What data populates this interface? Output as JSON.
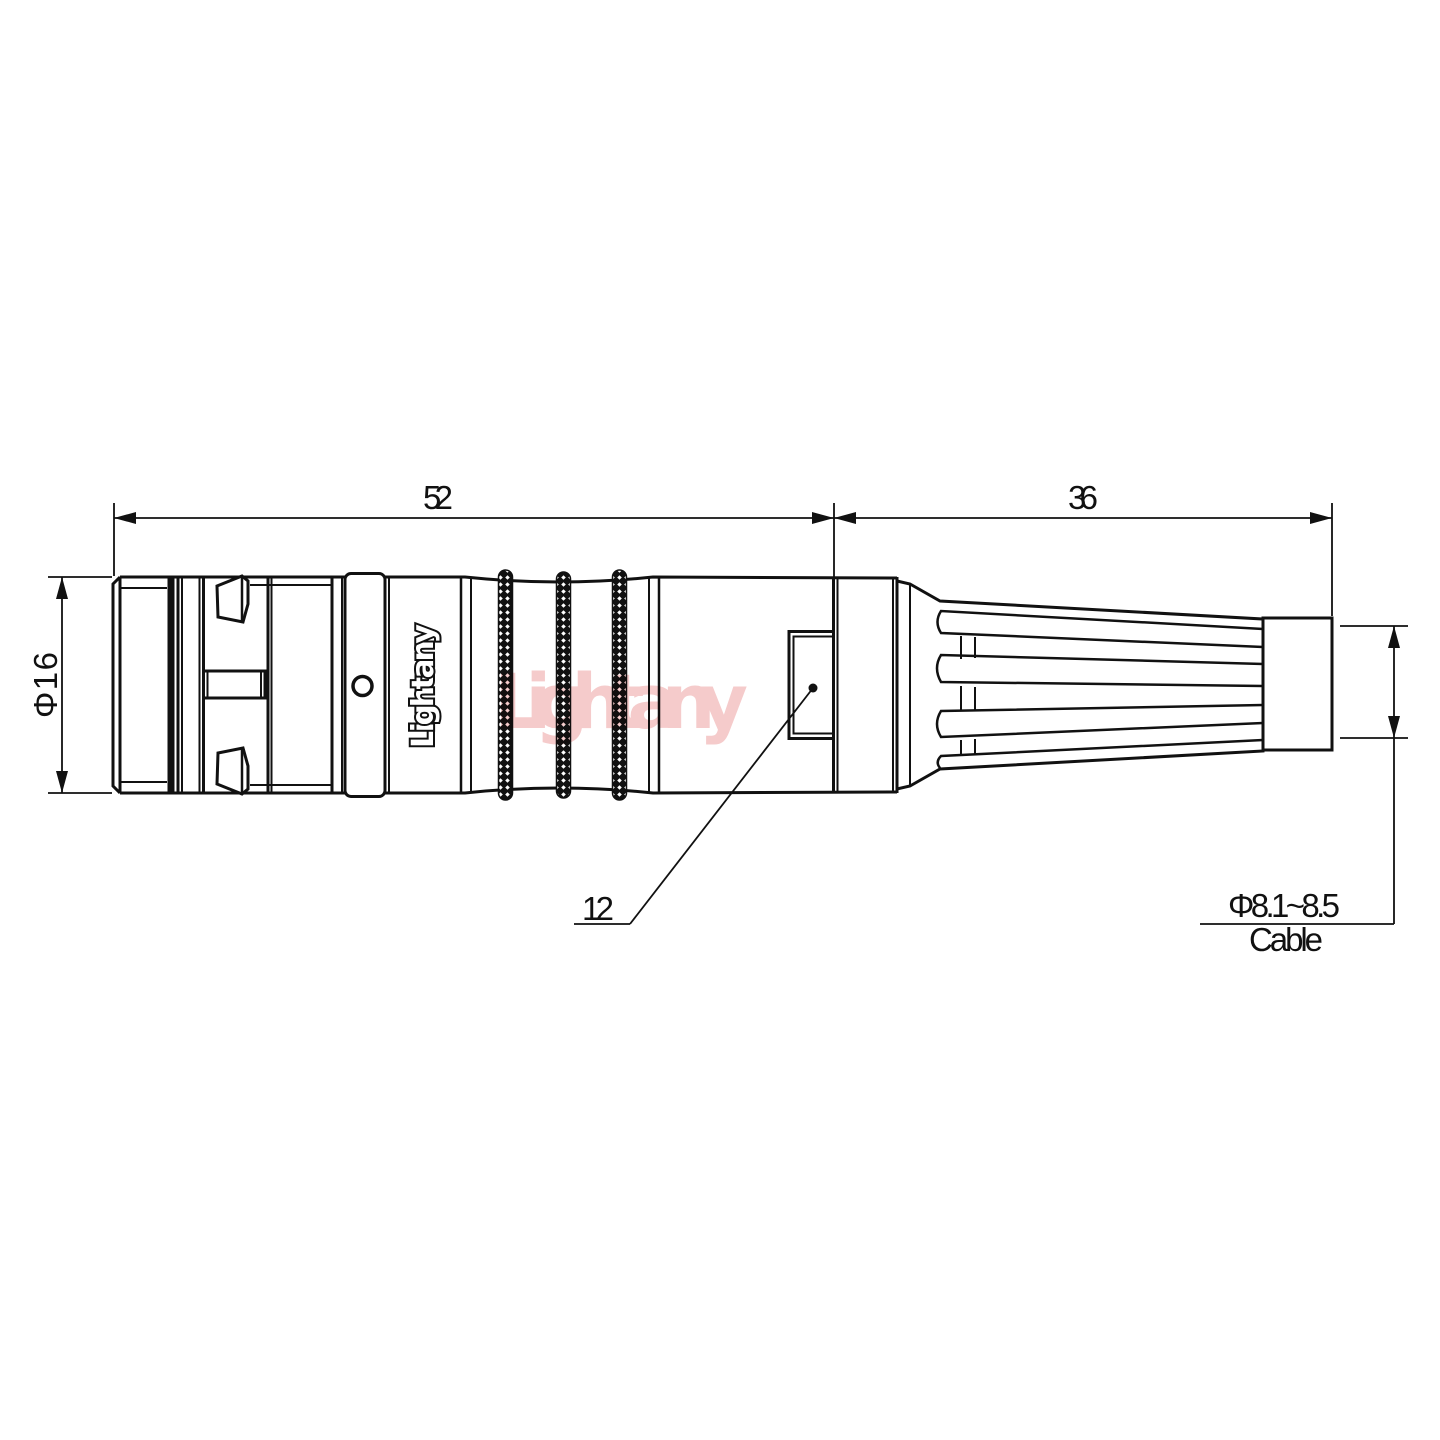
{
  "drawing": {
    "brand": "Lightany",
    "watermark": "Lightany",
    "dims": {
      "body_length": "52",
      "boot_length": "36",
      "body_diameter": "Φ16",
      "window_dimension": "12",
      "cable_range": "Φ8.1~8.5",
      "cable_label": "Cable"
    },
    "colors": {
      "ink": "#111111",
      "watermark_pink": "#f2bdbd",
      "background": "#ffffff"
    }
  }
}
